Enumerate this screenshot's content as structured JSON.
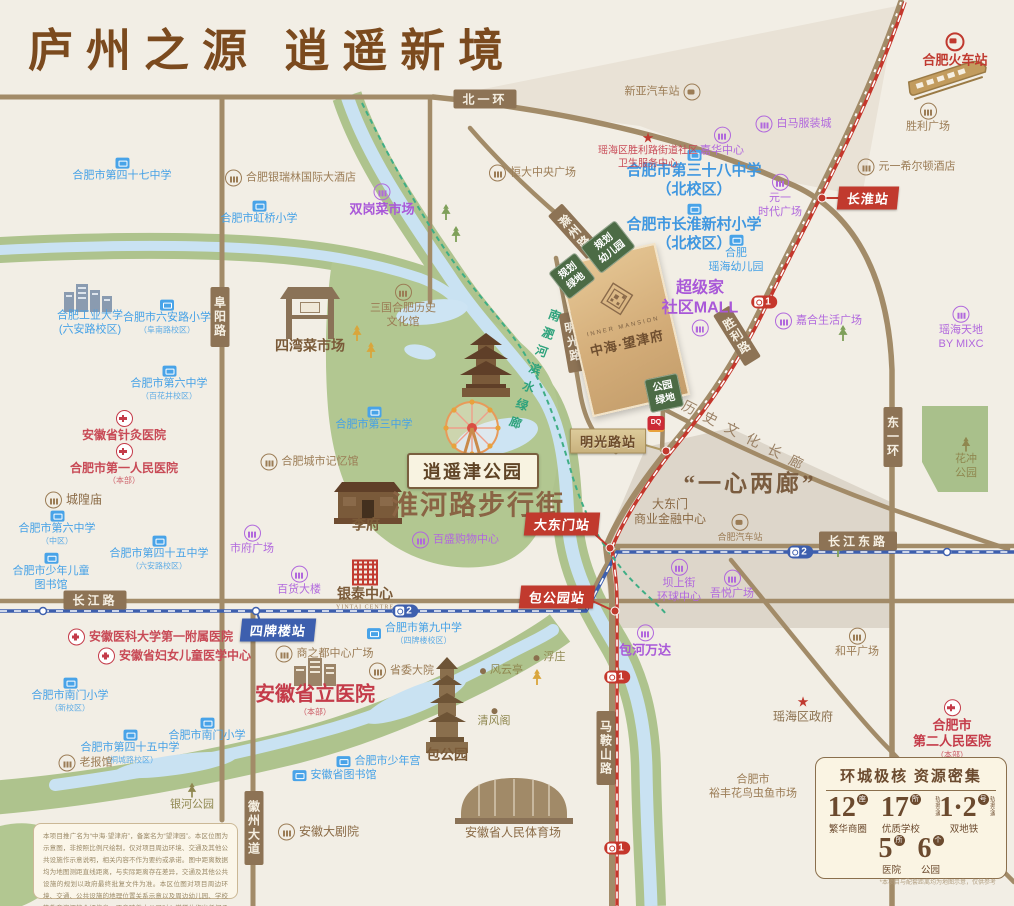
{
  "title": "庐州之源  逍遥新境",
  "site": {
    "name_en": "INNER MANSION",
    "name": "中海·望津府"
  },
  "featured": {
    "park_badge": "逍遥津公园",
    "street": "淮河路步行街",
    "plan": "“一心两廊”",
    "corridor": "历史文化长廊",
    "river_walk": "南淝河滨水绿廊",
    "dq": "DQ"
  },
  "colors": {
    "title": "#7b4a1e",
    "road": "#a28b68",
    "metro_line1": "#c5372c",
    "metro_line2": "#3d5fae",
    "school": "#45a1e6",
    "commercial": "#a958d8",
    "hospital": "#c43b49",
    "landmark": "#9b7c55",
    "park": "#b2c791",
    "water": "#c9e2f2",
    "site_gold": "#d2ab77"
  },
  "road_tags": [
    {
      "label": "北一环",
      "x": 485,
      "y": 99,
      "o": "h"
    },
    {
      "label": "长江路",
      "x": 95,
      "y": 600,
      "o": "h"
    },
    {
      "label": "长江东路",
      "x": 858,
      "y": 541,
      "o": "h"
    },
    {
      "label": "阜阳路",
      "x": 220,
      "y": 317,
      "o": "v"
    },
    {
      "label": "徽州大道",
      "x": 254,
      "y": 828,
      "o": "v"
    },
    {
      "label": "马鞍山路",
      "x": 606,
      "y": 748,
      "o": "v"
    },
    {
      "label": "东一环",
      "x": 893,
      "y": 437,
      "o": "v"
    },
    {
      "label": "滁州路",
      "x": 575,
      "y": 232,
      "o": "v",
      "rot": -42
    },
    {
      "label": "淮南路",
      "x": 649,
      "y": 279,
      "o": "v",
      "rot": -18
    },
    {
      "label": "明光路",
      "x": 573,
      "y": 342,
      "o": "v",
      "rot": -10
    },
    {
      "label": "胜利路",
      "x": 737,
      "y": 336,
      "o": "v",
      "rot": -32
    }
  ],
  "stations": [
    {
      "label": "长淮站",
      "x": 868,
      "y": 198,
      "s": "red"
    },
    {
      "label": "大东门站",
      "x": 562,
      "y": 524,
      "s": "red"
    },
    {
      "label": "包公园站",
      "x": 557,
      "y": 597,
      "s": "red"
    },
    {
      "label": "四牌楼站",
      "x": 278,
      "y": 630,
      "s": "blue"
    },
    {
      "label": "明光路站",
      "x": 608,
      "y": 441,
      "s": "tan"
    }
  ],
  "metro_badges": [
    {
      "line": "2",
      "x": 405,
      "y": 611
    },
    {
      "line": "2",
      "x": 800,
      "y": 552
    },
    {
      "line": "1",
      "x": 764,
      "y": 302
    },
    {
      "line": "1",
      "x": 617,
      "y": 677
    },
    {
      "line": "1",
      "x": 617,
      "y": 848
    }
  ],
  "gboxes": [
    {
      "l": [
        "规划",
        "幼儿园"
      ],
      "x": 608,
      "y": 247,
      "rot": -38
    },
    {
      "l": [
        "规划",
        "绿地"
      ],
      "x": 572,
      "y": 276,
      "rot": -38
    },
    {
      "l": [
        "公园",
        "绿地"
      ],
      "x": 664,
      "y": 393,
      "rot": -12
    }
  ],
  "pois": [
    {
      "l": [
        "合肥市第四十七中学"
      ],
      "x": 122,
      "y": 170,
      "t": "school"
    },
    {
      "l": [
        "合肥市虹桥小学"
      ],
      "x": 259,
      "y": 213,
      "t": "school"
    },
    {
      "l": [
        "合肥工业大学",
        "(六安路校区)"
      ],
      "x": 90,
      "y": 323,
      "t": "school",
      "i": "none"
    },
    {
      "l": [
        "合肥市六安路小学"
      ],
      "s": "（阜南路校区）",
      "x": 167,
      "y": 317,
      "t": "school"
    },
    {
      "l": [
        "合肥市第六中学"
      ],
      "s": "（百花井校区）",
      "x": 169,
      "y": 383,
      "t": "school"
    },
    {
      "l": [
        "合肥市第三中学"
      ],
      "x": 374,
      "y": 419,
      "t": "school"
    },
    {
      "l": [
        "合肥市第三十八中学",
        "（北校区）"
      ],
      "x": 694,
      "y": 174,
      "t": "schoolB"
    },
    {
      "l": [
        "合肥市长淮新村小学",
        "（北校区）"
      ],
      "x": 694,
      "y": 228,
      "t": "schoolB"
    },
    {
      "l": [
        "合肥",
        "瑶海幼儿园"
      ],
      "x": 736,
      "y": 254,
      "t": "school"
    },
    {
      "l": [
        "合肥市第六中学"
      ],
      "s": "（中区）",
      "x": 57,
      "y": 528,
      "t": "school"
    },
    {
      "l": [
        "合肥市少年儿童",
        "图书馆"
      ],
      "x": 51,
      "y": 572,
      "t": "school"
    },
    {
      "l": [
        "合肥市第四十五中学"
      ],
      "s": "（六安路校区）",
      "x": 159,
      "y": 553,
      "t": "school"
    },
    {
      "l": [
        "合肥市第九中学"
      ],
      "s": "（四牌楼校区）",
      "x": 414,
      "y": 634,
      "t": "school",
      "ip": "l"
    },
    {
      "l": [
        "合肥市南门小学"
      ],
      "s": "（新校区）",
      "x": 70,
      "y": 695,
      "t": "school"
    },
    {
      "l": [
        "合肥市南门小学"
      ],
      "x": 207,
      "y": 730,
      "t": "school"
    },
    {
      "l": [
        "合肥市第四十五中学"
      ],
      "s": "（桐城路校区）",
      "x": 130,
      "y": 747,
      "t": "school"
    },
    {
      "l": [
        "合肥市少年宫"
      ],
      "x": 378,
      "y": 762,
      "t": "school",
      "ip": "l"
    },
    {
      "l": [
        "安徽省图书馆"
      ],
      "x": 334,
      "y": 776,
      "t": "school",
      "ip": "l"
    },
    {
      "l": [
        "双岗菜市场"
      ],
      "x": 382,
      "y": 200,
      "t": "mallM"
    },
    {
      "l": [
        "白马服装城"
      ],
      "x": 793,
      "y": 124,
      "t": "mall",
      "ip": "l"
    },
    {
      "l": [
        "嘉华中心"
      ],
      "x": 722,
      "y": 142,
      "t": "mall"
    },
    {
      "l": [
        "元一",
        "时代广场"
      ],
      "x": 780,
      "y": 196,
      "t": "mall"
    },
    {
      "l": [
        "超级家",
        "社区MALL"
      ],
      "x": 700,
      "y": 308,
      "t": "mallB",
      "ip": "b"
    },
    {
      "l": [
        "嘉合生活广场"
      ],
      "x": 818,
      "y": 321,
      "t": "mall",
      "ip": "l"
    },
    {
      "l": [
        "瑶海天地",
        "BY MIXC"
      ],
      "x": 961,
      "y": 328,
      "t": "mall"
    },
    {
      "l": [
        "市府广场"
      ],
      "x": 252,
      "y": 540,
      "t": "mall"
    },
    {
      "l": [
        "百货大楼"
      ],
      "x": 299,
      "y": 581,
      "t": "mall"
    },
    {
      "l": [
        "百盛购物中心"
      ],
      "x": 455,
      "y": 540,
      "t": "mall",
      "ip": "l"
    },
    {
      "l": [
        "包河万达"
      ],
      "x": 645,
      "y": 641,
      "t": "mallM"
    },
    {
      "l": [
        "坝上街",
        "环球中心"
      ],
      "x": 679,
      "y": 581,
      "t": "mall"
    },
    {
      "l": [
        "吾悦广场"
      ],
      "x": 732,
      "y": 585,
      "t": "mall"
    },
    {
      "l": [
        "合肥银瑞林国际大酒店"
      ],
      "x": 290,
      "y": 178,
      "t": "brn",
      "ip": "l"
    },
    {
      "l": [
        "新亚汽车站"
      ],
      "x": 663,
      "y": 92,
      "t": "brn",
      "i": "bus",
      "ip": "r"
    },
    {
      "l": [
        "恒大中央广场"
      ],
      "x": 532,
      "y": 173,
      "t": "brn",
      "ip": "l"
    },
    {
      "l": [
        "胜利广场"
      ],
      "x": 928,
      "y": 118,
      "t": "brn"
    },
    {
      "l": [
        "元一希尔顿酒店"
      ],
      "x": 906,
      "y": 167,
      "t": "brn",
      "ip": "l"
    },
    {
      "l": [
        "四湾菜市场"
      ],
      "x": 310,
      "y": 347,
      "t": "brnB",
      "i": "none"
    },
    {
      "l": [
        "三国合肥历史",
        "文化馆"
      ],
      "x": 403,
      "y": 306,
      "t": "brn"
    },
    {
      "l": [
        "合肥城市记忆馆"
      ],
      "x": 309,
      "y": 462,
      "t": "brn",
      "ip": "l"
    },
    {
      "l": [
        "城隍庙"
      ],
      "x": 73,
      "y": 500,
      "t": "brnM",
      "ip": "l"
    },
    {
      "l": [
        "老报馆"
      ],
      "x": 85,
      "y": 763,
      "t": "brn",
      "ip": "l"
    },
    {
      "l": [
        "商之都中心广场"
      ],
      "x": 324,
      "y": 654,
      "t": "brn",
      "ip": "l"
    },
    {
      "l": [
        "省委大院"
      ],
      "x": 401,
      "y": 671,
      "t": "brn",
      "ip": "l"
    },
    {
      "l": [
        "安徽大剧院"
      ],
      "x": 318,
      "y": 832,
      "t": "brnM",
      "ip": "l"
    },
    {
      "l": [
        "大东门",
        "商业金融中心"
      ],
      "x": 670,
      "y": 512,
      "t": "brnM",
      "i": "none"
    },
    {
      "l": [
        "合肥汽车站"
      ],
      "x": 740,
      "y": 528,
      "t": "brnS",
      "i": "bus"
    },
    {
      "l": [
        "和平广场"
      ],
      "x": 857,
      "y": 643,
      "t": "brn"
    },
    {
      "l": [
        "合肥市",
        "裕丰花鸟虫鱼市场"
      ],
      "x": 753,
      "y": 787,
      "t": "brn",
      "i": "none"
    },
    {
      "l": [
        "李府"
      ],
      "x": 366,
      "y": 526,
      "t": "brnB",
      "i": "none"
    },
    {
      "l": [
        "包公园"
      ],
      "x": 447,
      "y": 756,
      "t": "brnB",
      "i": "none"
    },
    {
      "l": [
        "清风阁"
      ],
      "x": 494,
      "y": 718,
      "t": "olive",
      "i": "dot"
    },
    {
      "l": [
        "风云亭"
      ],
      "x": 501,
      "y": 671,
      "t": "olive",
      "i": "dot",
      "ip": "l"
    },
    {
      "l": [
        "浮庄"
      ],
      "x": 549,
      "y": 658,
      "t": "olive",
      "i": "dot",
      "ip": "l"
    },
    {
      "l": [
        "安徽省人民体育场"
      ],
      "x": 513,
      "y": 833,
      "t": "brnM",
      "i": "none"
    },
    {
      "l": [
        "银河公园"
      ],
      "x": 192,
      "y": 797,
      "t": "olive",
      "i": "tree"
    },
    {
      "l": [
        "花冲",
        "公园"
      ],
      "x": 966,
      "y": 458,
      "t": "olive",
      "i": "tree"
    },
    {
      "l": [
        "安徽省针灸医院"
      ],
      "x": 124,
      "y": 426,
      "t": "hosp"
    },
    {
      "l": [
        "合肥市第一人民医院"
      ],
      "s": "（本部）",
      "x": 124,
      "y": 464,
      "t": "hosp"
    },
    {
      "l": [
        "安徽医科大学第一附属医院"
      ],
      "x": 150,
      "y": 637,
      "t": "hosp",
      "ip": "l"
    },
    {
      "l": [
        "安徽省妇女儿童医学中心"
      ],
      "x": 174,
      "y": 656,
      "t": "hosp",
      "ip": "l"
    },
    {
      "l": [
        "安徽省立医院"
      ],
      "s": "（本部）",
      "x": 315,
      "y": 700,
      "t": "hospB",
      "i": "none"
    },
    {
      "l": [
        "合肥市",
        "第二人民医院"
      ],
      "s": "（本部）",
      "x": 952,
      "y": 729,
      "t": "hospM"
    },
    {
      "l": [
        "瑶海区胜利路街道社区",
        "卫生服务中心"
      ],
      "x": 648,
      "y": 150,
      "t": "hospS",
      "i": "star"
    },
    {
      "l": [
        "瑶海区政府"
      ],
      "x": 803,
      "y": 709,
      "t": "gov",
      "i": "star"
    },
    {
      "l": [
        "合肥火车站"
      ],
      "x": 955,
      "y": 50,
      "t": "rail",
      "i": "rail"
    },
    {
      "l": [
        "银泰中心"
      ],
      "x": 365,
      "y": 585,
      "t": "brnB",
      "i": "yintai",
      "en": "YINTAI CENTRE"
    }
  ],
  "trees": [
    {
      "x": 446,
      "y": 212,
      "c": "g"
    },
    {
      "x": 456,
      "y": 234,
      "c": "g"
    },
    {
      "x": 357,
      "y": 333,
      "c": "y"
    },
    {
      "x": 371,
      "y": 350,
      "c": "y"
    },
    {
      "x": 843,
      "y": 333,
      "c": "g"
    },
    {
      "x": 838,
      "y": 549,
      "c": "g"
    },
    {
      "x": 537,
      "y": 677,
      "c": "y"
    }
  ],
  "legend": {
    "title": "环城极核  资源密集",
    "stats": [
      {
        "num": "12",
        "unit": "座",
        "label": "繁华商圈"
      },
      {
        "num": "17",
        "unit": "所",
        "label": "优质学校"
      },
      {
        "num": "1·2",
        "unit": "号",
        "label": "双地铁",
        "micro": "轨道交通"
      },
      {
        "num": "5",
        "unit": "所",
        "label": "医院"
      },
      {
        "num": "6",
        "unit": "个",
        "label": "公园"
      }
    ],
    "note": "*本项目与配套距离均为地图示意，仅供参考"
  },
  "disclaimer": "本项目推广名为“中海·望津府”，备案名为“望津园”。本区位图为示意图，非按照比例尺绘制，仅对项目周边环境、交通及其他公共设施作示意说明，相关内容不作为要约或承诺。图中距离数据均为地图测距直线距离，与实际距离存在差异，交通及其他公共设施的规划以政府最终批复文件为准。本区位图对项目周边环境、交通、公共设施的地理位置关系示意以及周边幼儿园、学校等教育资源的介绍信息，不意味着本公司对入学学位作出任何承诺。以上资料为截止于2025年6月的情况，最终以政府规划及实际情况为准；一旦相关事项发生变动，不再另行通知，敬请留意最新资料。开发商：合肥中海置业有限公司。"
}
